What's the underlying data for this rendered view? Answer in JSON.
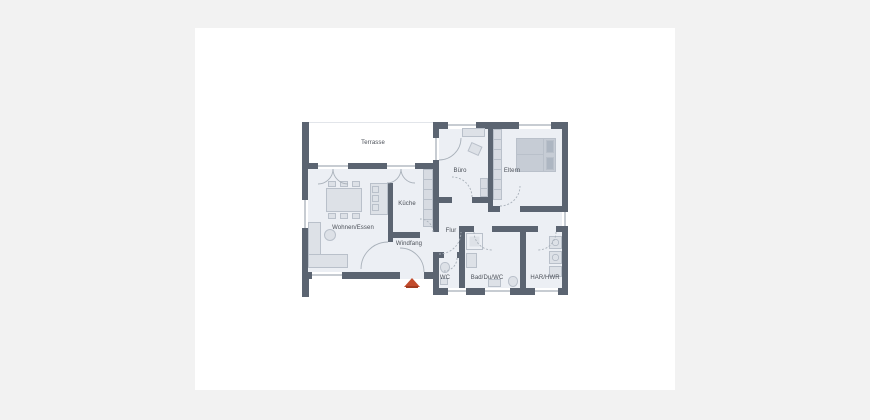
{
  "plan": {
    "type": "floor-plan",
    "rooms": [
      {
        "id": "terrasse",
        "label": "Terrasse"
      },
      {
        "id": "wohnen-essen",
        "label": "Wohnen/Essen"
      },
      {
        "id": "kueche",
        "label": "Küche"
      },
      {
        "id": "windfang",
        "label": "Windfang"
      },
      {
        "id": "buero",
        "label": "Büro"
      },
      {
        "id": "eltern",
        "label": "Eltern"
      },
      {
        "id": "flur",
        "label": "Flur"
      },
      {
        "id": "wc",
        "label": "WC"
      },
      {
        "id": "bad",
        "label": "Bad/Du/WC"
      },
      {
        "id": "har",
        "label": "HAR/HWR"
      }
    ],
    "markers": {
      "entrance_arrow": {
        "shape": "triangle-up",
        "meaning": "entrance marker"
      }
    },
    "colors": {
      "backdrop": "#f2f2f2",
      "canvas": "#ffffff",
      "wall": "#5b6471",
      "floor": "#eceff4",
      "furn": "#dde1e7",
      "stroke": "#b9c0ca",
      "units": "#d7dbe2",
      "bed": "#c6ccd5",
      "pillow": "#adb6c2",
      "label": "#4a4f57",
      "arc": "#a9b1ba",
      "winline": "#8f99a6",
      "arrow": "#c24b2c",
      "arrowdark": "#a23b20",
      "terraceline": "#e2e5ea"
    }
  }
}
